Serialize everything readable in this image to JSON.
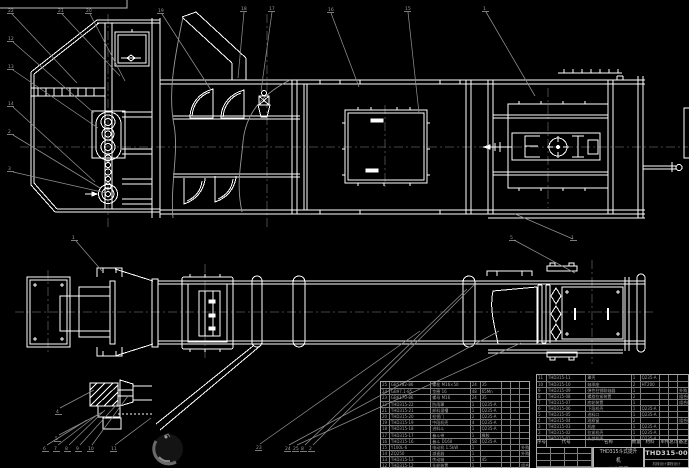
{
  "colors": {
    "background": "#000000",
    "line": "#ffffff",
    "leader": "#8f8f8f",
    "centerline": "#5a5a5a",
    "table_line": "#a8a8a8",
    "table_text": "#a5a5a5",
    "title_text": "#cfcfcf"
  },
  "title_block": {
    "drawing_name_line1": "THD315斗式提升机",
    "drawing_name_line2": "总装配图",
    "drawing_number": "THD315-00",
    "org_line": "机械设计课程设计",
    "bom_header": [
      "序号",
      "代号",
      "名称",
      "数量",
      "材料",
      "单件",
      "总计",
      "备注"
    ]
  },
  "bom_left": {
    "rows": [
      [
        "25",
        "GB5782-86",
        "螺栓 M16×50",
        "24",
        "35",
        "",
        "",
        ""
      ],
      [
        "24",
        "GB97.1-85",
        "垫圈 16",
        "48",
        "65Mn",
        "",
        "",
        ""
      ],
      [
        "23",
        "GB6170-86",
        "螺母 M16",
        "24",
        "35",
        "",
        "",
        ""
      ],
      [
        "22",
        "THD315-22",
        "防雨罩",
        "1",
        "Q235-A",
        "",
        "",
        ""
      ],
      [
        "21",
        "THD315-21",
        "卸料溜槽",
        "1",
        "Q235-A",
        "",
        "",
        ""
      ],
      [
        "20",
        "THD315-20",
        "检视门",
        "2",
        "Q235-A",
        "",
        "",
        ""
      ],
      [
        "19",
        "THD315-19",
        "中段机壳",
        "4",
        "Q235-A",
        "",
        "",
        ""
      ],
      [
        "18",
        "THD315-18",
        "进料斗",
        "1",
        "Q235-A",
        "",
        "",
        ""
      ],
      [
        "17",
        "THD315-17",
        "畚斗带",
        "1",
        "橡胶",
        "",
        "",
        ""
      ],
      [
        "16",
        "THD315-16",
        "畚斗 D160",
        "58",
        "Q235-A",
        "",
        "",
        ""
      ],
      [
        "15",
        "Y100L-6",
        "电动机 1.5kW",
        "1",
        "",
        "",
        "",
        "外购"
      ],
      [
        "14",
        "ZQ250",
        "减速器",
        "1",
        "",
        "",
        "",
        "外购"
      ],
      [
        "13",
        "THD315-13",
        "传动轴",
        "1",
        "45",
        "",
        "",
        ""
      ],
      [
        "12",
        "THD315-12",
        "头轮装置",
        "1",
        "",
        "",
        "",
        "组合件"
      ]
    ]
  },
  "bom_right": {
    "rows": [
      [
        "11",
        "THD315-11",
        "罩壳",
        "1",
        "Q235-A",
        "",
        "",
        ""
      ],
      [
        "10",
        "THD315-10",
        "轴承座",
        "2",
        "HT200",
        "",
        "",
        ""
      ],
      [
        "9",
        "THD315-09",
        "弹性柱销联轴器",
        "1",
        "",
        "",
        "",
        "外购"
      ],
      [
        "8",
        "THD315-08",
        "螺旋拉紧装置",
        "2",
        "",
        "",
        "",
        "组合件"
      ],
      [
        "7",
        "THD315-07",
        "底轮装置",
        "1",
        "",
        "",
        "",
        "组合件"
      ],
      [
        "6",
        "THD315-06",
        "下段机壳",
        "1",
        "Q235-A",
        "",
        "",
        ""
      ],
      [
        "5",
        "THD315-05",
        "进料口",
        "1",
        "Q235-A",
        "",
        "",
        ""
      ],
      [
        "4",
        "THD315-04",
        "观察窗",
        "2",
        "",
        "",
        "",
        "组合件"
      ],
      [
        "3",
        "THD315-03",
        "机座",
        "1",
        "Q235-A",
        "",
        "",
        ""
      ],
      [
        "2",
        "THD315-02",
        "拉紧机壳",
        "1",
        "Q235-A",
        "",
        "",
        ""
      ],
      [
        "1",
        "THD315-01",
        "头部机壳",
        "1",
        "Q235-A",
        "",
        "",
        ""
      ]
    ]
  },
  "callouts": [
    {
      "label": "22",
      "x": 8,
      "y": 8,
      "tx": 77,
      "ty": 83
    },
    {
      "label": "21",
      "x": 58,
      "y": 8,
      "tx": 120,
      "ty": 76
    },
    {
      "label": "20",
      "x": 86,
      "y": 8,
      "tx": 125,
      "ty": 81
    },
    {
      "label": "19",
      "x": 158,
      "y": 8,
      "tx": 211,
      "ty": 90
    },
    {
      "label": "18",
      "x": 241,
      "y": 6,
      "tx": 238,
      "ty": 78
    },
    {
      "label": "17",
      "x": 269,
      "y": 6,
      "tx": 261,
      "ty": 91
    },
    {
      "label": "16",
      "x": 328,
      "y": 7,
      "tx": 359,
      "ty": 87
    },
    {
      "label": "15",
      "x": 405,
      "y": 6,
      "tx": 419,
      "ty": 113
    },
    {
      "label": "1",
      "x": 483,
      "y": 6,
      "tx": 535,
      "ty": 96
    },
    {
      "label": "12",
      "x": 8,
      "y": 36,
      "tx": 94,
      "ty": 113
    },
    {
      "label": "13",
      "x": 8,
      "y": 64,
      "tx": 98,
      "ty": 128
    },
    {
      "label": "14",
      "x": 8,
      "y": 101,
      "tx": 95,
      "ty": 182
    },
    {
      "label": "2",
      "x": 8,
      "y": 129,
      "tx": 100,
      "ty": 188
    },
    {
      "label": "3",
      "x": 8,
      "y": 166,
      "tx": 106,
      "ty": 193
    },
    {
      "label": "1",
      "x": 72,
      "y": 235,
      "tx": 102,
      "ty": 271
    },
    {
      "label": "5",
      "x": 510,
      "y": 235,
      "tx": 575,
      "ty": 273
    },
    {
      "label": "1",
      "x": 571,
      "y": 235,
      "tx": 515,
      "ty": 214
    },
    {
      "label": "6",
      "x": 43,
      "y": 446,
      "tx": 87,
      "ty": 420
    },
    {
      "label": "7",
      "x": 54,
      "y": 446,
      "tx": 97,
      "ty": 415
    },
    {
      "label": "8",
      "x": 65,
      "y": 446,
      "tx": 105,
      "ty": 410
    },
    {
      "label": "9",
      "x": 76,
      "y": 446,
      "tx": 118,
      "ty": 403
    },
    {
      "label": "10",
      "x": 88,
      "y": 446,
      "tx": 128,
      "ty": 396
    },
    {
      "label": "11",
      "x": 111,
      "y": 446,
      "tx": 151,
      "ty": 418
    },
    {
      "label": "5",
      "x": 55,
      "y": 436,
      "tx": 103,
      "ty": 412
    },
    {
      "label": "4",
      "x": 56,
      "y": 409,
      "tx": 94,
      "ty": 390
    },
    {
      "label": "23",
      "x": 256,
      "y": 445,
      "tx": 420,
      "ty": 331
    },
    {
      "label": "24",
      "x": 285,
      "y": 446,
      "tx": 499,
      "ty": 331
    },
    {
      "label": "25",
      "x": 293,
      "y": 446,
      "tx": 521,
      "ty": 343
    },
    {
      "label": "8",
      "x": 301,
      "y": 446,
      "tx": 467,
      "ty": 289
    },
    {
      "label": "2",
      "x": 309,
      "y": 446,
      "tx": 474,
      "ty": 285
    }
  ]
}
